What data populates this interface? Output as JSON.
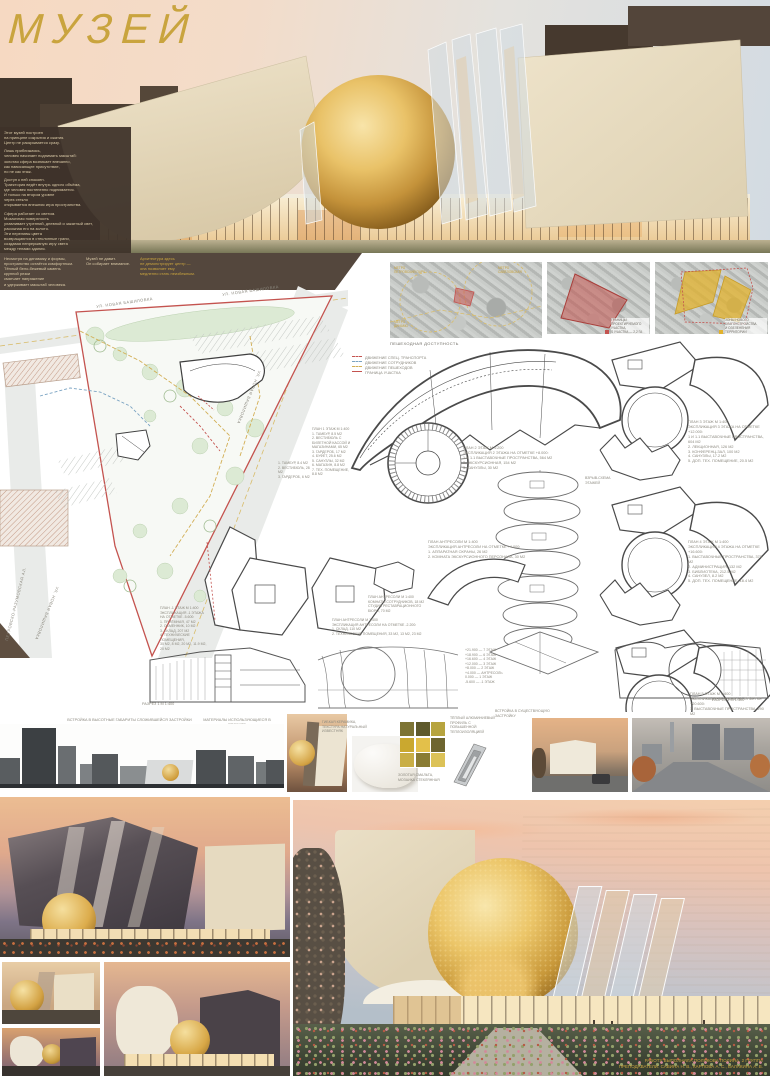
{
  "title": "МУЗЕЙ",
  "intro": {
    "p1": "Этот музей построен\nна принципе сокрытия и сжатия.\nЦентр не раскрывается сразу.",
    "p2": "Лишь приближаясь,\nчеловек начинает поднимать масштаб:\nзолотая сфера возникает внезапно,\nкак нависающее присутствие,\nно не как этаж.",
    "p3": "Доступ к ней спокоен.\nТраектория ведёт внутрь одного объёма,\nгде человек постепенно поднимается.\nИ только на втором уровне\nчерез стекло\nоткрывается внешняя игра пространства.",
    "p4": "Сфера работает со светом.\nМозаичная поверхность\nулавливает утренний, дневной и закатный свет,\nрассыпая его на золото.\nЭти переливы цвета\nвозвращаются в стеклянные грани,\nсоздавая непрерывную игру света\nмежду телами здания."
  },
  "band": {
    "col1": "Несмотря на динамику и формы,\nпространство остаётся комфортным.\nТёплый бело-бежевый камень\nкрупной резки\nсмягчает напряжение\nи удерживает масштаб человека.",
    "col2": "Музей не давит.\nОн собирает внимание.",
    "col3": "Архитектура здесь\nне демонстрирует центр —\nона позволяет ему\nмедленно стать неизбежным."
  },
  "maps": {
    "caption": "ПЕШЕХОДНАЯ ДОСТУПНОСТЬ",
    "label_a": "МЕТРО\nПЕТРОВСКИЙ ПАРК",
    "label_b": "МЕТРО\nСАВЁЛОВСКАЯ",
    "label_c": "МЕТРО\nДИНАМО",
    "map2_legend": "ГРАНИЦЫ ПРОЕКТИРУЕМОГО УЧАСТКА,\nS УЧАСТКА — 2,2 ГА",
    "map3_legend": "ЗОНЫ НОВОГО БЛАГОУСТРОЙСТВА\nИ ОЗЕЛЕНЕНИЯ ТЕРРИТОРИИ"
  },
  "siteplan": {
    "street_top": "УЛ. НОВАЯ БАШИЛОВКА",
    "street_top2": "УЛ. НОВАЯ БАШИЛОВКА",
    "street_right": "УЛ. НОВАЯ БАШИЛОВКА",
    "street_bottom": "УЛ. НОВАЯ БАШИЛОВКА",
    "street_left": "ПЕТРОВСКО-РАЗУМОВСКАЯ АЛ.",
    "legend": [
      {
        "label": "ДВИЖЕНИЕ СПЕЦ. ТРАНСПОРТА"
      },
      {
        "label": "ДВИЖЕНИЕ СОТРУДНИКОВ"
      },
      {
        "label": "ДВИЖЕНИЕ ПЕШЕХОДОВ"
      },
      {
        "label": "ГРАНИЦА УЧАСТКА"
      }
    ]
  },
  "plans": {
    "floor1": "ПЛАН 1 ЭТАЖ М 1:400\n1. ТАМБУР, 8.5 М2\n2. ВЕСТИБЮЛЬ С БИЛЕТНОЙ КАССОЙ И МАГАЗИНАМИ, 65 М2\n3. ГАРДЕРОБ, 17 М2\n4. БУФЕТ, 25.6 М2\n5. САНУЗЛЫ, 32 М2\n6. МАГАЗИН, 8.8 М2\n7. ТЕХ. ПОМЕЩЕНИЕ, 8.8 М2",
    "floor1b": "1. ТАМБУР, 8.4 М2\n2. ВЕСТИБЮЛЬ, 28 М2\n3. ГАРДЕРОБ, 6 М2",
    "floor2": "ПЛАН 2 ЭТАЖ М 1:200\nЭКСПЛИКАЦИЯ 2 ЭТАЖА НА ОТМЕТКЕ +8.000:\n1 И 1.1 ВЫСТАВОЧНЫЕ ПРОСТРАНСТВА, 564 М2\n2. ЭКСКУРСИОННАЯ, 154 М2\n3. САНУЗЛЫ, 30 М2",
    "floor3": "ПЛАН 3 ЭТАЖ М 1:400\nЭКСПЛИКАЦИЯ 3 ЭТАЖА НА ОТМЕТКЕ +12.000:\n1 И 1.1 ВЫСТАВОЧНЫЕ ПРОСТРАНСТВА, 604 М2\n2. ЛЕКЦИОННАЯ, 126 М2\n3. КОНФЕРЕНЦ-ЗАЛ, 100 М2\n4. САНУЗЛЫ, 17.2 М2\n5. ДОП. ТЕХ. ПОМЕЩЕНИЕ, 20.5 М2",
    "floor4": "ПЛАН 4 ЭТАЖ М 1:400\nЭКСПЛИКАЦИЯ 4 ЭТАЖА НА ОТМЕТКЕ +16.600:\n1. ВЫСТАВОЧНЫЕ ПРОСТРАНСТВА, 370 М2\n2. АДМИНИСТРАЦИЯ, 132 М2\n3. БИБЛИОТЕКА, 212.5 М2\n4. САНУЗЕЛ, 8.2 М2\n5. ДОП. ТЕХ. ПОМЕЩЕНИЕ, 18.4 М2",
    "floor5": "ПЛАН 5 ЭТАЖ М 1:400\nЭКСПЛИКАЦИЯ 5 ЭТАЖА НА ОТМЕТКЕ +20.600:\n1. ВЫСТАВОЧНЫЕ ПРОСТРАНСТВА, 290 М2",
    "mezz1": "ПЛАН АНТРЕСОЛИ М 1:400\nЭКСПЛИКАЦИЯ АНТРЕСОЛИ НА ОТМЕТКЕ +4.000:\n1. АППАРАТНАЯ ОХРАНЫ, 26 М2\n2. КОМНАТА ЭКСКУРСИОННОГО ПЕРСОНАЛА, 30 М2",
    "mezz2": "ПЛАН АНТРЕСОЛИ М 1:400\nЭКСПЛИКАЦИЯ АНТРЕСОЛИ НА ОТМЕТКЕ -2.200:\n1. СКЛАД, 110 М2\n2. ТЕХНИЧЕСКИЕ ПОМЕЩЕНИЯ, 33 М2, 13 М2, 23 М2",
    "mezz3": "ПЛАН АНТРЕСОЛИ М 1:400\nКОМНАТЫ СОТРУДНИКОВ, 18 М2\nСТУДИЯ РЕСТАВРАЦИОННОГО БЮРО, 70 М2",
    "basement": "ПЛАН -1 ЭТАЖ М 1:400\nЭКСПЛИКАЦИЯ -1 ЭТАЖА\nНА ОТМЕТКЕ -5.600:\n1. ПРИЁМНАЯ, 47 М2\n2. ОБМЕННИК, 10 М2\n3. СКЛАД, 207 М2\n4. ТЕХНИЧЕСКИЕ ПОМЕЩЕНИЯ,\n30 М2, 8 М2, 20 М2, 11.9 М2, 20 М2",
    "axon_label": "ВЗРЫВ-СХЕМА\nЭТАЖЕЙ",
    "section1": "РАЗРЕЗ 1 М 1:400",
    "section2": "РАЗРЕЗ 2 М 1:400",
    "levels": "+21.900 — 7 ЭТАЖ\n+18.900 — 6 ЭТАЖ\n+16.600 — 4 ЭТАЖ\n+12.000 — 3 ЭТАЖ\n+8.000 — 2 ЭТАЖ\n+4.000 — АНТРЕСОЛЬ\n0.000 — 1 ЭТАЖ\n-5.600 — -1 ЭТАЖ"
  },
  "materials": {
    "elevation_label": "ВСТРОЙКА В ВЫСОТНЫЕ ГАБАРИТЫ СЛОЖИВШЕЙСЯ ЗАСТРОЙКИ",
    "materials_label": "МАТЕРИАЛЫ ИСПОЛЬЗУЮЩИЕСЯ В ПРОЕКТЕ",
    "mat1": "ГИБКАЯ КЕРАМИКА,\nТЕКСТУРА НАТУРАЛЬНЫЙ\nИЗВЕСТНЯК",
    "mat2": "ЗОЛОТАЯ СМАЛЬТА,\nМОЗАИКА СТЕКЛЯННАЯ",
    "mat3": "ТЁПЛЫЙ АЛЮМИНИЕВЫЙ\nПРОФИЛЬ С ПОВЫШЕННОЙ\nТЕПЛОИЗОЛЯЦИЕЙ",
    "context_label": "ВСТРОЙКА В СУЩЕСТВУЮЩУЮ\nЗАСТРОЙКУ"
  },
  "credits": {
    "line1": "РАБОТУ ВЫПОЛНИЛА ПОЛЯКОВА ПОЛИНА, 2 ГРУППА",
    "line2": "ПРЕПОДАВАТЕЛИ: САВИНА Н. В., КАРПОВА А. С., БАЛАКИНА А. В."
  },
  "colors": {
    "gold": "#c9a43e",
    "stone": "#e7dcc4",
    "dark_brown": "#46392f",
    "band_brown": "#54473d",
    "boundary_red": "#c4534f",
    "movement_blue": "#7aa3c2",
    "movement_gold": "#d2ae54"
  }
}
